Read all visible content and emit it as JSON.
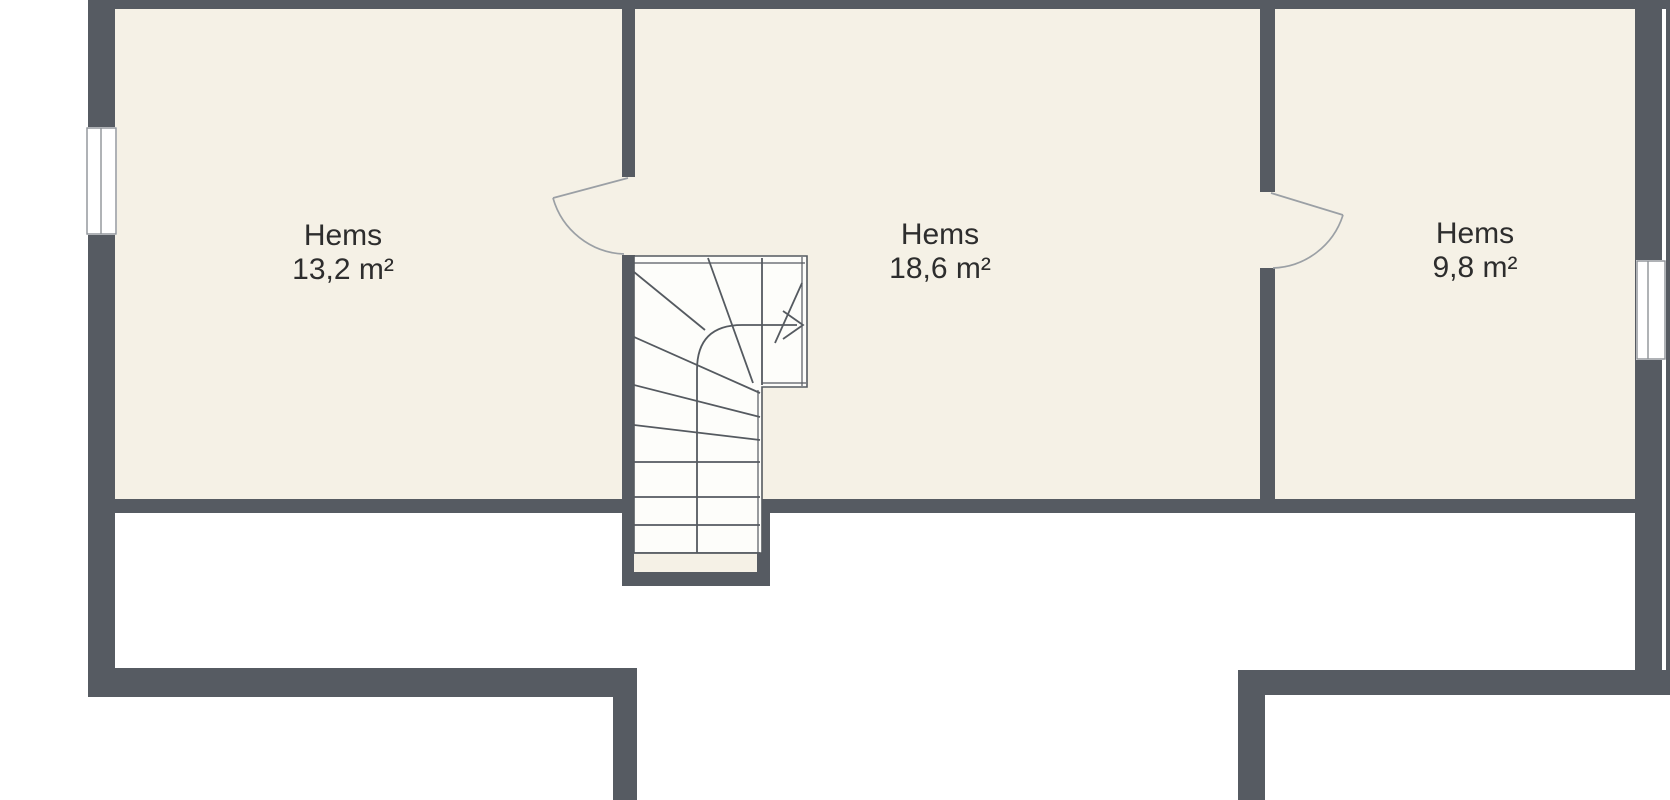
{
  "colors": {
    "background": "#ffffff",
    "wall": "#565b62",
    "floor": "#f5f1e6",
    "stair_fill": "#fdfdfa",
    "line": "#555a60",
    "door_line": "#9ba0a5",
    "frame_line": "#8d9297",
    "text": "#2d2d2d"
  },
  "rooms": [
    {
      "name": "Hems",
      "area": "13,2 m²"
    },
    {
      "name": "Hems",
      "area": "18,6 m²"
    },
    {
      "name": "Hems",
      "area": "9,8 m²"
    }
  ],
  "stairs": {
    "arrow_icon": "arrow-right",
    "type": "winder-staircase"
  },
  "features": {
    "doors": 2,
    "windows": 2
  }
}
